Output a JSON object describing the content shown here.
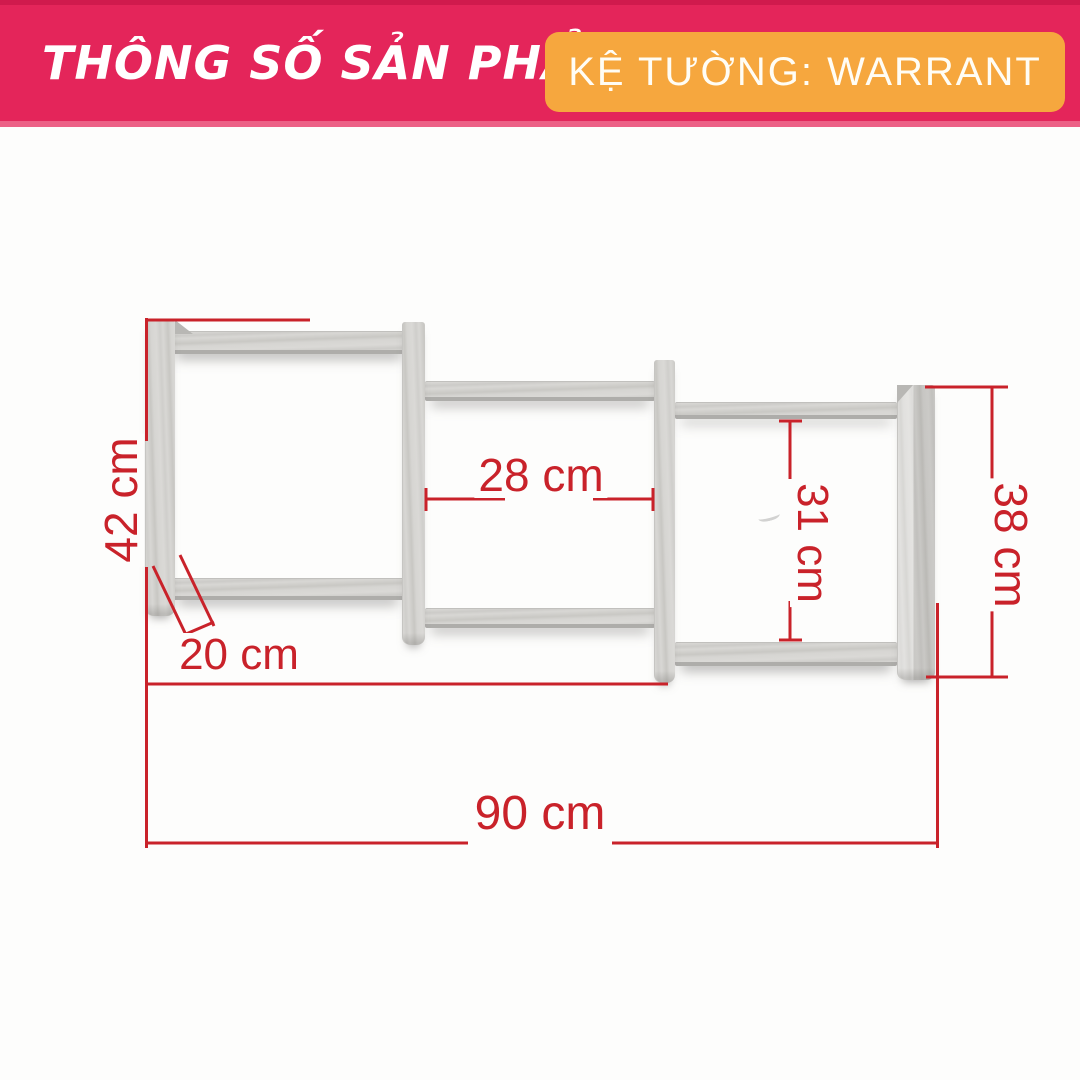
{
  "header": {
    "title": "THÔNG SỐ SẢN PHẨM",
    "product_badge": "KỆ TƯỜNG: WARRANT"
  },
  "colors": {
    "header_pink": "#e4255a",
    "badge_orange": "#f6a73e",
    "dimension_red": "#c9222a",
    "wood_gray": "#d6d5d2",
    "background": "#fdfdfc"
  },
  "diagram": {
    "subject": "three-tier staggered wall shelf, wood finish",
    "unit": "cm",
    "dimensions": {
      "left_height": {
        "label": "42 cm",
        "value": 42
      },
      "shelf_depth": {
        "label": "20 cm",
        "value": 20
      },
      "middle_inner_width": {
        "label": "28 cm",
        "value": 28
      },
      "right_inner_height": {
        "label": "31 cm",
        "value": 31
      },
      "right_height": {
        "label": "38 cm",
        "value": 38
      },
      "total_width": {
        "label": "90 cm",
        "value": 90
      }
    }
  }
}
